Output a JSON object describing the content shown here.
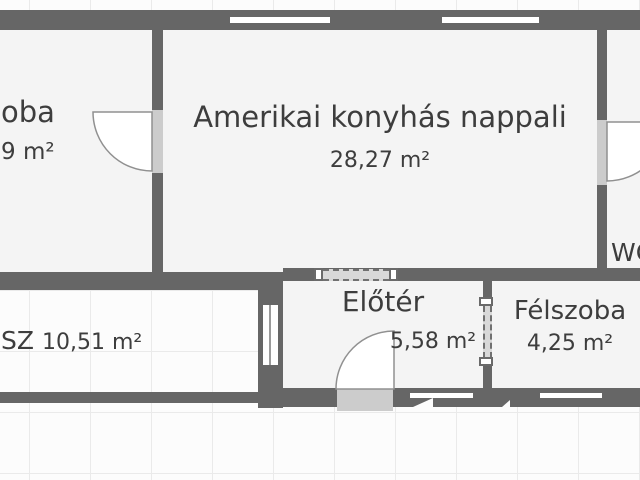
{
  "floorplan": {
    "rooms": {
      "szoba": {
        "name": "oba",
        "area": "9 m²"
      },
      "nappali": {
        "name": "Amerikai konyhás nappali",
        "area": "28,27 m²"
      },
      "wc": {
        "name": "WC"
      },
      "terasz": {
        "name": "SZ",
        "area": "10,51 m²"
      },
      "eloter": {
        "name": "Előtér",
        "area": "5,58 m²"
      },
      "felszoba": {
        "name": "Félszoba",
        "area": "4,25 m²"
      }
    },
    "colors": {
      "wall": "#666666",
      "room_fill": "#f4f4f4",
      "door_opening": "#cccccc",
      "door_arc": "#909090",
      "text": "#3d3d3d",
      "grid_line": "#eaeaea",
      "background": "#fcfcfc"
    }
  }
}
